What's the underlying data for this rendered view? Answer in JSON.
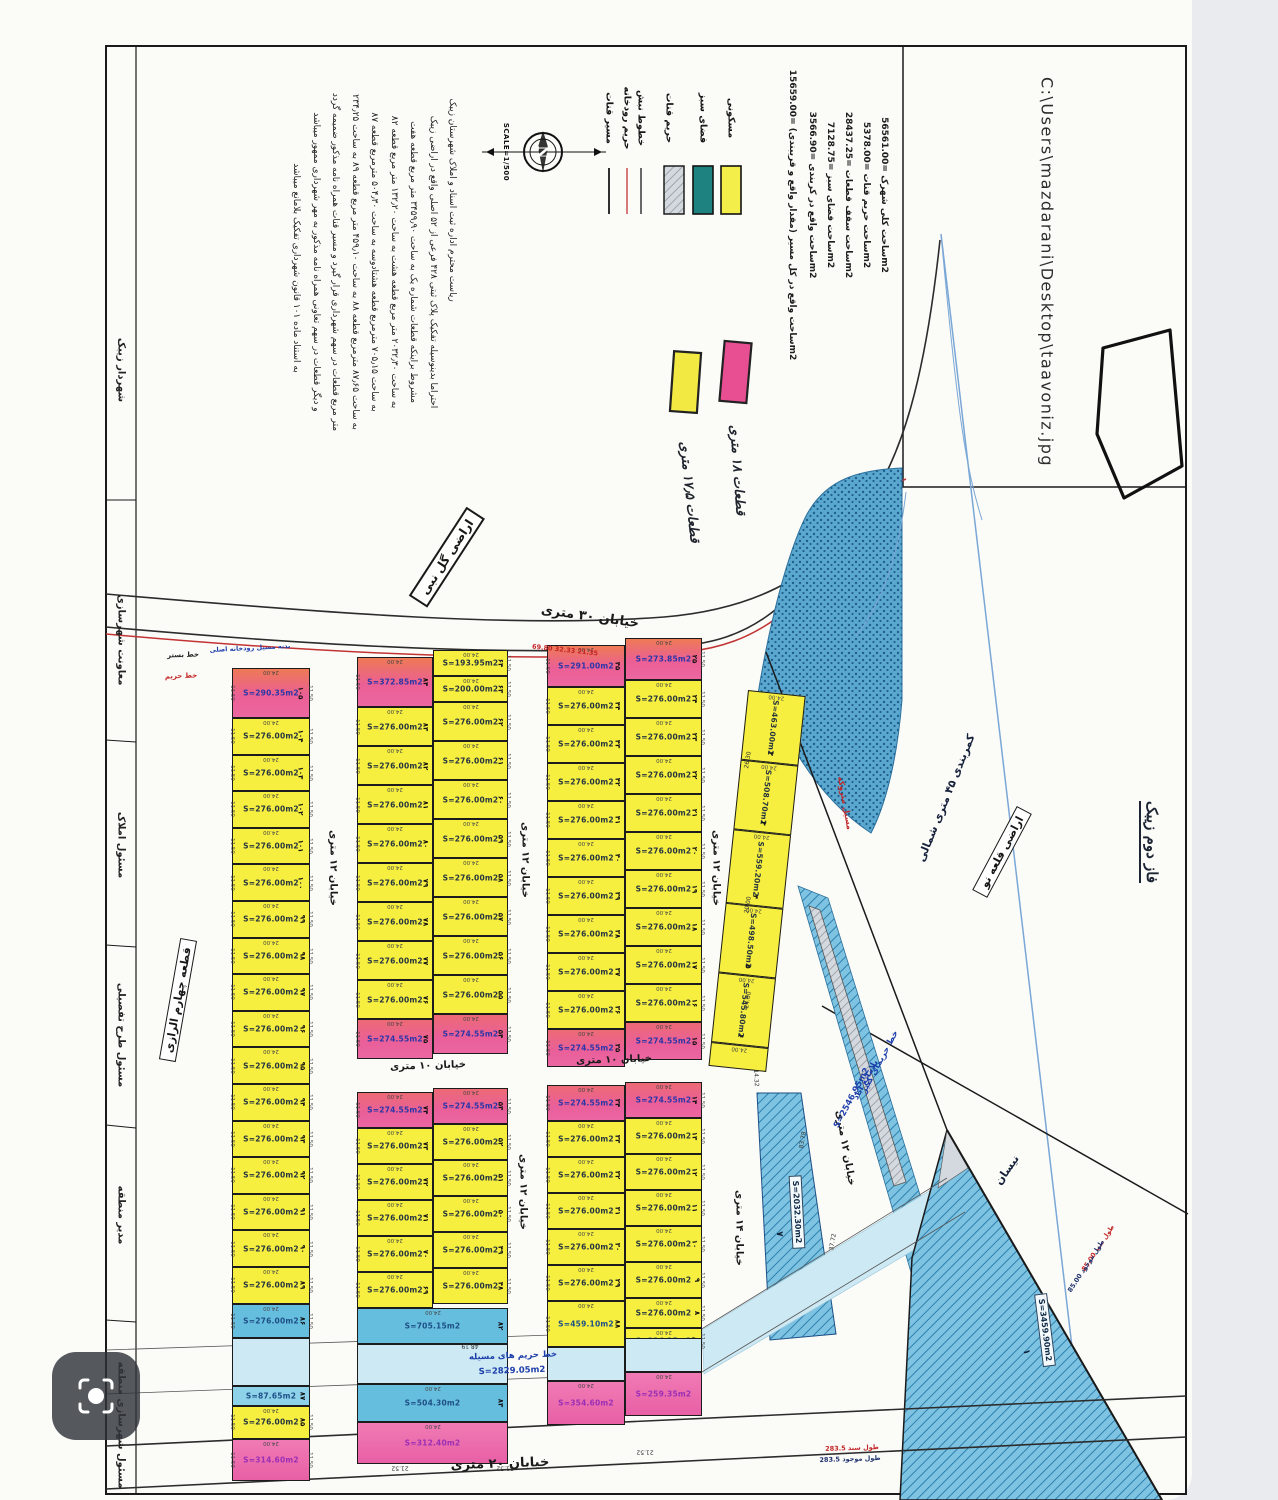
{
  "title": "نقشه تفکیکی اراضی تعاونی - زیبک",
  "header_box": {
    "file_path": "C:\\Users\\mazdarani\\Desktop\\taavoniz.jpg"
  },
  "compass": {
    "letter": "N",
    "scale_label": "SCALE=1/500"
  },
  "legend": {
    "swatches": [
      {
        "name": "residential",
        "label": "مسکونی",
        "color": "#f3ee49"
      },
      {
        "name": "green-space",
        "label": "فضای سبز",
        "color": "#1e8380"
      },
      {
        "name": "qanat-buffer",
        "label": "حریم قنات",
        "color": "#a9cddd"
      },
      {
        "name": "section-lines",
        "label": "خطوط نبش",
        "color": "#1a1a1a"
      },
      {
        "name": "river-buffer",
        "label": "حریم رودخانه",
        "color": "#c23333"
      },
      {
        "name": "qanat-route",
        "label": "مسیر قنات",
        "color": "#1a1a1a"
      }
    ],
    "stats": [
      "ساحت کلی شهرک =56561.00m2",
      "ساحت حریم قنات =5378.00m2",
      "ساحت سقف قطعات =28437.25m2",
      "ساحت فضای سبز =7128.75m2",
      "ساحت واقع در کربندی =3566.90m2",
      "ساحت واقع در کل مسیر (مقدار واقع و قریبندی) =15659.00m2"
    ]
  },
  "notes": [
    {
      "name": "pink-note",
      "label": "قطعات ۱۸ متری",
      "color": "#e84f93"
    },
    {
      "name": "yellow-note",
      "label": "قطعات ۱۷٫۵ متری",
      "color": "#f2ea43"
    }
  ],
  "paragraph": {
    "lines": [
      "ریاست محترم اداره ثبت اسناد و املاک شهرستان زیبک",
      "احتراما بدینوسیله تفکیک پلاک ثبتی ۴۲۸ فرعی از ۵۲ اصلی واقع در اراضی زیبک",
      "مشروط براینکه قطعات شماره یک به ساحت ۳۴۵۹٫۹۰ متر مربع قطعه هفت",
      "به ساحت ۲۰۳۲٫۳۰ متر مربع قطعه هشت به ساحت ۱۳۲٫۲۰ متر مربع قطعه ۸۲",
      "به ساحت ۷۰۵٫۱۵ مترمربع قطعه هشتادوسه به ساحت ۵۰۴٫۳۰ مترمربع قطعه ۸۷",
      "به ساحت ۸۷٫۶۵ مترمربع قطعه ۸۸ به ساحت ۴۵۹٫۱۰ متر مربع قطعه ۸۹ به ساحت ۲۳۴٫۲۵",
      "متر مربع قطعات در سهم شهرداری قرار گیرد و مسیر قنات همراه نامه مذکور ضمیمه گردد",
      "و دیگر قطعات در سهم تعاونی همراه نامه مذکور به مهر شهرداری ممهور میباشد",
      "به استناد ماده ۱۰۱ قانون شهرداری تفکیک بلامانع میباشد"
    ]
  },
  "labels": [
    {
      "t": "C:\\Users\\mazdarani\\Desktop\\taavoniz.jpg",
      "x": 1047,
      "y": 272,
      "r": 90,
      "c": "path",
      "n": "file-path"
    },
    {
      "t": "ساحت کلی شهرک =56561.00m2",
      "x": 884,
      "y": 195,
      "r": 90,
      "c": "stat",
      "n": "stat-total-area"
    },
    {
      "t": "ساحت حریم قنات =5378.00m2",
      "x": 866,
      "y": 195,
      "r": 90,
      "c": "stat",
      "n": "stat-qanat-buffer"
    },
    {
      "t": "ساحت سقف قطعات =28437.25m2",
      "x": 848,
      "y": 195,
      "r": 90,
      "c": "stat",
      "n": "stat-plots-area"
    },
    {
      "t": "ساحت فضای سبز =7128.75m2",
      "x": 830,
      "y": 195,
      "r": 90,
      "c": "stat",
      "n": "stat-green-area"
    },
    {
      "t": "ساحت واقع در کربندی =3566.90m2",
      "x": 812,
      "y": 195,
      "r": 90,
      "c": "stat",
      "n": "stat-beltway-area"
    },
    {
      "t": "ساحت واقع در کل مسیر (مقدار واقع و قریبندی) =15659.00m2",
      "x": 792,
      "y": 215,
      "r": 90,
      "c": "stat",
      "n": "stat-route-area"
    },
    {
      "t": "مسکونی",
      "x": 731,
      "y": 118,
      "r": 90,
      "c": "leg",
      "n": "legend-residential"
    },
    {
      "t": "فضای سبز",
      "x": 703,
      "y": 118,
      "r": 90,
      "c": "leg",
      "n": "legend-green-space"
    },
    {
      "t": "حریم قنات",
      "x": 669,
      "y": 118,
      "r": 90,
      "c": "leg",
      "n": "legend-qanat-buffer"
    },
    {
      "t": "خطوط نبش",
      "x": 641,
      "y": 118,
      "r": 90,
      "c": "leg",
      "n": "legend-section-lines"
    },
    {
      "t": "حریم رودخانه",
      "x": 627,
      "y": 118,
      "r": 90,
      "c": "leg",
      "n": "legend-river-buffer"
    },
    {
      "t": "مسیر قنات",
      "x": 609,
      "y": 118,
      "r": 90,
      "c": "leg",
      "n": "legend-qanat-route"
    },
    {
      "t": "SCALE=1/500",
      "x": 506,
      "y": 152,
      "r": 90,
      "c": "scale",
      "n": "scale-label"
    },
    {
      "t": "ریاست محترم اداره ثبت اسناد و املاک شهرستان زیبک",
      "x": 452,
      "y": 200,
      "r": 90,
      "c": "para",
      "n": "letter-line"
    },
    {
      "t": "احتراما بدینوسیله تفکیک پلاک ثبتی ۴۲۸ فرعی از ۵۲ اصلی واقع در اراضی زیبک",
      "x": 433,
      "y": 262,
      "r": 90,
      "c": "para",
      "n": "letter-line"
    },
    {
      "t": "مشروط براینکه قطعات شماره یک به ساحت ۳۴۵۹٫۹۰ متر مربع قطعه هفت",
      "x": 413,
      "y": 262,
      "r": 90,
      "c": "para",
      "n": "letter-line"
    },
    {
      "t": "به ساحت ۲۰۳۲٫۳۰ متر مربع قطعه هشت به ساحت ۱۳۲٫۲۰ متر مربع قطعه ۸۲",
      "x": 394,
      "y": 262,
      "r": 90,
      "c": "para",
      "n": "letter-line"
    },
    {
      "t": "به ساحت ۷۰۵٫۱۵ مترمربع قطعه هشتادوسه به ساحت ۵۰۴٫۳۰ مترمربع قطعه ۸۷",
      "x": 374,
      "y": 262,
      "r": 90,
      "c": "para",
      "n": "letter-line"
    },
    {
      "t": "به ساحت ۸۷٫۶۵ مترمربع قطعه ۸۸ به ساحت ۴۵۹٫۱۰ متر مربع قطعه ۸۹ به ساحت ۲۳۴٫۲۵",
      "x": 355,
      "y": 262,
      "r": 90,
      "c": "para",
      "n": "letter-line"
    },
    {
      "t": "متر مربع قطعات در سهم شهرداری قرار گیرد و مسیر قنات همراه نامه مذکور ضمیمه گردد",
      "x": 335,
      "y": 262,
      "r": 90,
      "c": "para",
      "n": "letter-line"
    },
    {
      "t": "و دیگر قطعات در سهم تعاونی همراه نامه مذکور به مهر شهرداری ممهور میباشد",
      "x": 316,
      "y": 262,
      "r": 90,
      "c": "para",
      "n": "letter-line"
    },
    {
      "t": "به استناد ماده ۱۰۱ قانون شهرداری تفکیک بلامانع میباشد",
      "x": 296,
      "y": 268,
      "r": 90,
      "c": "para",
      "n": "letter-line"
    },
    {
      "t": "قطعات ۱۸ متری",
      "x": 737,
      "y": 470,
      "r": 86,
      "c": "hand",
      "n": "pink-note-label"
    },
    {
      "t": "قطعات ۱۷٫۵ متری",
      "x": 689,
      "y": 492,
      "r": 84,
      "c": "hand",
      "n": "yellow-note-label"
    },
    {
      "t": "اراضی گل نبی",
      "x": 447,
      "y": 557,
      "r": -57,
      "c": "stamp",
      "n": "stamp-golnabi"
    },
    {
      "t": "خیابان ۳۰ متری",
      "x": 590,
      "y": 617,
      "r": 8,
      "c": "street",
      "n": "street-30m"
    },
    {
      "t": "69.80  32.33  21.35",
      "x": 565,
      "y": 650,
      "r": 6,
      "c": "red6",
      "n": "road-dims-red"
    },
    {
      "t": "بدنه مسیل رودخانه اصلی",
      "x": 250,
      "y": 648,
      "r": -3,
      "c": "blue6",
      "n": "river-note"
    },
    {
      "t": "خط بستر",
      "x": 183,
      "y": 655,
      "r": -2,
      "c": "tiny",
      "n": "bed-line-label"
    },
    {
      "t": "خط حریم",
      "x": 181,
      "y": 676,
      "r": -2,
      "c": "tinyred",
      "n": "buffer-line-label"
    },
    {
      "t": "خیابان ۱۲ متری",
      "x": 333,
      "y": 868,
      "r": 90,
      "c": "streetS",
      "n": "street-12m"
    },
    {
      "t": "خیابان ۱۲ متری",
      "x": 525,
      "y": 860,
      "r": 90,
      "c": "streetS",
      "n": "street-12m"
    },
    {
      "t": "خیابان ۱۲ متری",
      "x": 716,
      "y": 868,
      "r": 90,
      "c": "streetS",
      "n": "street-12m"
    },
    {
      "t": "خیابان ۱۰ متری",
      "x": 428,
      "y": 1066,
      "r": -2,
      "c": "streetS",
      "n": "street-10m"
    },
    {
      "t": "خیابان ۱۰ متری",
      "x": 614,
      "y": 1060,
      "r": -2,
      "c": "streetS",
      "n": "street-10m"
    },
    {
      "t": "خیابان ۱۲ متری",
      "x": 523,
      "y": 1192,
      "r": 90,
      "c": "streetS",
      "n": "street-12m"
    },
    {
      "t": "خیابان ۱۴ متری",
      "x": 739,
      "y": 1228,
      "r": 90,
      "c": "streetS",
      "n": "street-14m"
    },
    {
      "t": "خیابان ۱۲ متری",
      "x": 845,
      "y": 1148,
      "r": 80,
      "c": "streetS",
      "n": "street-12m"
    },
    {
      "t": "خیابان ۲۰ متری",
      "x": 500,
      "y": 1464,
      "r": -2,
      "c": "street",
      "n": "street-20m"
    },
    {
      "t": "283.5 طول سند",
      "x": 852,
      "y": 1448,
      "r": -2,
      "c": "red6",
      "n": "doc-length"
    },
    {
      "t": "283.5 طول موجود",
      "x": 850,
      "y": 1459,
      "r": -2,
      "c": "navy6",
      "n": "existing-length"
    },
    {
      "t": "مسیل متروکه",
      "x": 845,
      "y": 803,
      "r": 80,
      "c": "red7",
      "n": "abandoned-wash-label"
    },
    {
      "t": "اراضی قلعه نو",
      "x": 1002,
      "y": 852,
      "r": -62,
      "c": "stampbox",
      "n": "qalenow-lands-label"
    },
    {
      "t": "کمربندی ۴۵ متری شمالی",
      "x": 946,
      "y": 798,
      "r": -68,
      "c": "kam",
      "n": "beltway-45m-label"
    },
    {
      "t": "فاز دوم زیبک",
      "x": 1150,
      "y": 842,
      "r": 90,
      "c": "phase",
      "n": "phase2-note"
    },
    {
      "t": "نیسان",
      "x": 1007,
      "y": 1170,
      "r": -55,
      "c": "kam",
      "n": "nisan-label"
    },
    {
      "t": "خط حریمای کبیر",
      "x": 880,
      "y": 1062,
      "r": -62,
      "c": "blue7",
      "n": "qanat-buffer-note"
    },
    {
      "t": "بلامانع آباد",
      "x": 866,
      "y": 1080,
      "r": -62,
      "c": "blue7",
      "n": "qanat-buffer-note"
    },
    {
      "t": "S=2546.95m2",
      "x": 852,
      "y": 1098,
      "r": -62,
      "c": "blue7",
      "n": "qanat-buffer-area"
    },
    {
      "t": "S=3459.90m2",
      "x": 1045,
      "y": 1330,
      "r": 83,
      "c": "pill",
      "n": "plot-area-label"
    },
    {
      "t": "۱",
      "x": 1026,
      "y": 1352,
      "r": 83,
      "c": "pnum",
      "n": "plot-number"
    },
    {
      "t": "S=2032.30m2",
      "x": 797,
      "y": 1212,
      "r": 87,
      "c": "pill",
      "n": "plot-area-label"
    },
    {
      "t": "۷",
      "x": 779,
      "y": 1234,
      "r": 87,
      "c": "pnum",
      "n": "plot-number"
    },
    {
      "t": "85.00 طول سند",
      "x": 1098,
      "y": 1248,
      "r": -57,
      "c": "red6",
      "n": "doc-length"
    },
    {
      "t": "85.00 طول موجود",
      "x": 1086,
      "y": 1266,
      "r": -57,
      "c": "navy6",
      "n": "existing-length"
    },
    {
      "t": "خط حریم های مسیله",
      "x": 513,
      "y": 1356,
      "r": -2,
      "c": "blue7",
      "n": "wash-buffer-label"
    },
    {
      "t": "S=2829.05m2",
      "x": 512,
      "y": 1371,
      "r": -2,
      "c": "blue7",
      "n": "wash-buffer-area"
    },
    {
      "t": "شهردار زیبک",
      "x": 121,
      "y": 370,
      "r": 90,
      "c": "sig",
      "n": "sig-mayor"
    },
    {
      "t": "معاونت شهرسازی",
      "x": 121,
      "y": 640,
      "r": 90,
      "c": "sig",
      "n": "sig-urban-deputy"
    },
    {
      "t": "مسئول املاک",
      "x": 121,
      "y": 845,
      "r": 90,
      "c": "sig",
      "n": "sig-estates"
    },
    {
      "t": "مسئول طرح تفصیلی",
      "x": 121,
      "y": 1035,
      "r": 90,
      "c": "sig",
      "n": "sig-detail-plan"
    },
    {
      "t": "مدیر منطقه",
      "x": 121,
      "y": 1215,
      "r": 90,
      "c": "sig",
      "n": "sig-district-manager"
    },
    {
      "t": "مسئول شهرسازی منطقه",
      "x": 121,
      "y": 1425,
      "r": 90,
      "c": "sig",
      "n": "sig-district-urban"
    },
    {
      "t": "قطعه چهارم الرازی",
      "x": 178,
      "y": 1000,
      "r": -80,
      "c": "stampbox",
      "n": "block4-razi-label"
    },
    {
      "t": "48.19",
      "x": 470,
      "y": 1346,
      "r": 180,
      "c": "dim6",
      "n": "dim"
    },
    {
      "t": "21.52",
      "x": 400,
      "y": 1468,
      "r": 180,
      "c": "dim6",
      "n": "dim"
    },
    {
      "t": "21.52",
      "x": 505,
      "y": 1468,
      "r": 180,
      "c": "dim6",
      "n": "dim"
    },
    {
      "t": "21.52",
      "x": 645,
      "y": 1452,
      "r": 180,
      "c": "dim6",
      "n": "dim"
    },
    {
      "t": "83.78",
      "x": 803,
      "y": 1140,
      "r": -80,
      "c": "dim6",
      "n": "dim"
    },
    {
      "t": "37.72",
      "x": 833,
      "y": 1242,
      "r": -80,
      "c": "dim6",
      "n": "dim"
    },
    {
      "t": "14.32",
      "x": 756,
      "y": 1078,
      "r": 87,
      "c": "dim6",
      "n": "dim"
    },
    {
      "t": "26.30",
      "x": 748,
      "y": 760,
      "r": -80,
      "c": "dim6",
      "n": "dim"
    },
    {
      "t": "20.00",
      "x": 748,
      "y": 905,
      "r": -80,
      "c": "dim6",
      "n": "dim"
    },
    {
      "t": "24.00",
      "x": 748,
      "y": 1000,
      "r": -80,
      "c": "dim6",
      "n": "dim"
    }
  ],
  "dims": {
    "top": "24.00",
    "side": "11.50"
  },
  "blocks": [
    {
      "x": 232,
      "y": 668,
      "w": 78,
      "side": "LR",
      "rows": [
        {
          "h": 50,
          "c": "pink",
          "a": "S=290.35m2",
          "n": 105,
          "tc": "blue"
        },
        {
          "r": 16,
          "h": 36.6,
          "c": "yellow",
          "a": "S=276.00m2",
          "nf": 104
        },
        {
          "h": 34,
          "c": "blue",
          "a": "S=276.00m2",
          "n": 86,
          "tc": "navy"
        },
        {
          "h": 48,
          "c": "band"
        },
        {
          "h": 20,
          "c": "thinblue",
          "a": "S=87.65m2",
          "n": 87,
          "tc": "navy"
        },
        {
          "h": 33,
          "c": "yellow",
          "a": "S=276.00m2",
          "n": 85
        },
        {
          "h": 42,
          "c": "pinkstrip",
          "a": "S=314.60m2",
          "tc": "purple"
        }
      ]
    },
    {
      "x": 357,
      "y": 657,
      "w": 76,
      "side": "L",
      "rows": [
        {
          "h": 50,
          "c": "pink",
          "a": "S=372.85m2",
          "n": 84,
          "tc": "blue"
        },
        {
          "r": 8,
          "h": 39,
          "c": "yellow",
          "a": "S=276.00m2",
          "nf": 83
        },
        {
          "h": 40,
          "c": "pink2",
          "a": "S=274.55m2",
          "n": 75,
          "tc": "blue"
        }
      ]
    },
    {
      "x": 433,
      "y": 650,
      "w": 75,
      "side": "R",
      "rows": [
        {
          "h": 26,
          "c": "yellow",
          "a": "S=193.95m2",
          "n": 64
        },
        {
          "h": 26,
          "c": "yellow",
          "a": "S=200.00m2",
          "n": 63
        },
        {
          "r": 8,
          "h": 39,
          "c": "yellow",
          "a": "S=276.00m2",
          "nf": 62
        },
        {
          "h": 40,
          "c": "pink2",
          "a": "S=274.55m2",
          "n": 54,
          "tc": "blue"
        }
      ]
    },
    {
      "x": 547,
      "y": 645,
      "w": 78,
      "side": "L",
      "rows": [
        {
          "h": 42,
          "c": "pink",
          "a": "S=291.00m2",
          "n": 45,
          "tc": "blue"
        },
        {
          "r": 9,
          "h": 38,
          "c": "yellow",
          "a": "S=276.00m2",
          "nf": 44
        },
        {
          "h": 38,
          "c": "pink2",
          "a": "S=274.55m2",
          "n": 35,
          "tc": "blue"
        }
      ]
    },
    {
      "x": 625,
      "y": 638,
      "w": 77,
      "side": "R",
      "rows": [
        {
          "h": 42,
          "c": "pink",
          "a": "S=273.85m2",
          "n": 25,
          "tc": "blue"
        },
        {
          "r": 9,
          "h": 38,
          "c": "yellow",
          "a": "S=276.00m2",
          "nf": 24
        },
        {
          "h": 38,
          "c": "pink2",
          "a": "S=274.55m2",
          "n": 15,
          "tc": "blue"
        }
      ]
    },
    {
      "x": 357,
      "y": 1092,
      "w": 76,
      "side": "L",
      "rows": [
        {
          "h": 36,
          "c": "pink2",
          "a": "S=274.55m2",
          "n": 74,
          "tc": "blue"
        },
        {
          "r": 5,
          "h": 36,
          "c": "yellow",
          "a": "S=276.00m2",
          "nf": 73
        }
      ]
    },
    {
      "x": 433,
      "y": 1088,
      "w": 75,
      "side": "R",
      "rows": [
        {
          "h": 36,
          "c": "pink2",
          "a": "S=274.55m2",
          "n": 53,
          "tc": "blue"
        },
        {
          "r": 5,
          "h": 36,
          "c": "yellow",
          "a": "S=276.00m2",
          "nf": 52
        }
      ]
    },
    {
      "x": 357,
      "y": 1308,
      "w": 151,
      "rows": [
        {
          "h": 36,
          "c": "blue",
          "a": "S=705.15m2",
          "n": 82,
          "tc": "navy"
        },
        {
          "h": 40,
          "c": "band"
        },
        {
          "h": 38,
          "c": "blue",
          "a": "S=504.30m2",
          "n": 83,
          "tc": "navy"
        },
        {
          "h": 42,
          "c": "pinkstrip",
          "a": "S=312.40m2",
          "tc": "purple"
        }
      ]
    },
    {
      "x": 547,
      "y": 1085,
      "w": 78,
      "side": "L",
      "rows": [
        {
          "h": 36,
          "c": "pink2",
          "a": "S=274.55m2",
          "n": 34,
          "tc": "blue"
        },
        {
          "r": 5,
          "h": 36,
          "c": "yellow",
          "a": "S=276.00m2",
          "nf": 33
        },
        {
          "h": 46,
          "c": "yellow",
          "a": "S=459.10m2",
          "n": 88,
          "tc": "navy"
        }
      ]
    },
    {
      "x": 625,
      "y": 1082,
      "w": 77,
      "side": "R",
      "rows": [
        {
          "h": 36,
          "c": "pink2",
          "a": "S=274.55m2",
          "n": 14,
          "tc": "blue"
        },
        {
          "r": 5,
          "h": 36,
          "c": "yellow",
          "a": "S=276.00m2",
          "nf": 13
        },
        {
          "h": 30,
          "c": "yellow",
          "a": "S=276.00m2",
          "n": 8
        },
        {
          "h": 26,
          "c": "yellow",
          "a": "S=234.25m2",
          "n": 89,
          "tc": "navy"
        }
      ]
    },
    {
      "x": 547,
      "y": 1347,
      "w": 78,
      "rows": [
        {
          "h": 34,
          "c": "band"
        },
        {
          "h": 44,
          "c": "pinkstrip",
          "a": "S=354.60m2",
          "tc": "purple"
        }
      ]
    },
    {
      "x": 625,
      "y": 1338,
      "w": 77,
      "rows": [
        {
          "h": 34,
          "c": "band"
        },
        {
          "h": 44,
          "c": "pinkstrip",
          "a": "S=259.35m2",
          "tc": "purple"
        }
      ]
    },
    {
      "x": 748,
      "y": 690,
      "w": 58,
      "rot": 6,
      "vert": true,
      "rows": [
        {
          "h": 70,
          "c": "yellow",
          "a": "S=463.00m2",
          "n": 2
        },
        {
          "h": 70,
          "c": "yellow",
          "a": "S=508.70m2",
          "n": 3
        },
        {
          "h": 74,
          "c": "yellow",
          "a": "S=559.20m2",
          "n": 4
        },
        {
          "h": 70,
          "c": "yellow",
          "a": "S=498.50m2",
          "n": 5
        },
        {
          "h": 70,
          "c": "yellow",
          "a": "S=545.80m2",
          "n": 6
        },
        {
          "h": 24,
          "c": "yellow"
        }
      ]
    }
  ],
  "overlay": {
    "camera_button": "دوربین جستجوی تصویری"
  }
}
